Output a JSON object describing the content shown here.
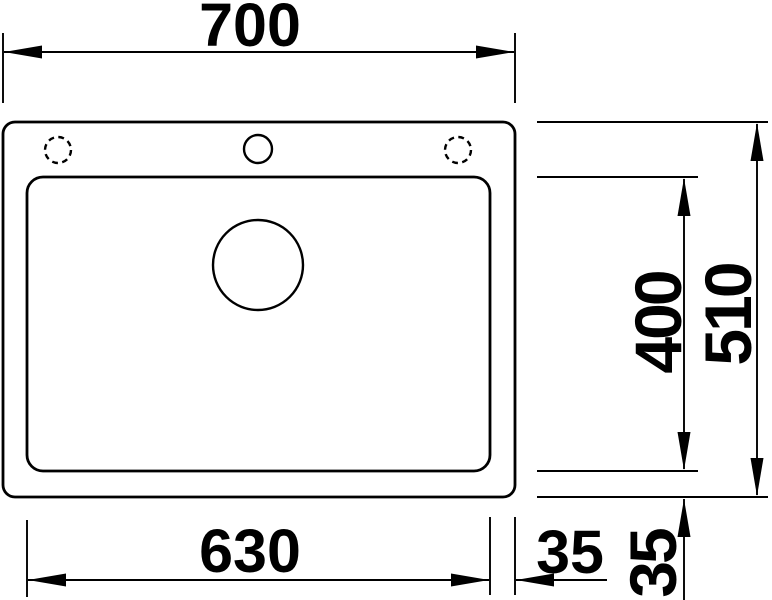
{
  "drawing": {
    "background_color": "#ffffff",
    "line_color": "#000000",
    "view": "sink top view dimension drawing"
  },
  "dims": {
    "overall_width": "700",
    "overall_depth": "510",
    "bowl_depth": "400",
    "bowl_width": "630",
    "rim_offset_side": "35",
    "rim_offset_bottom": "35"
  }
}
